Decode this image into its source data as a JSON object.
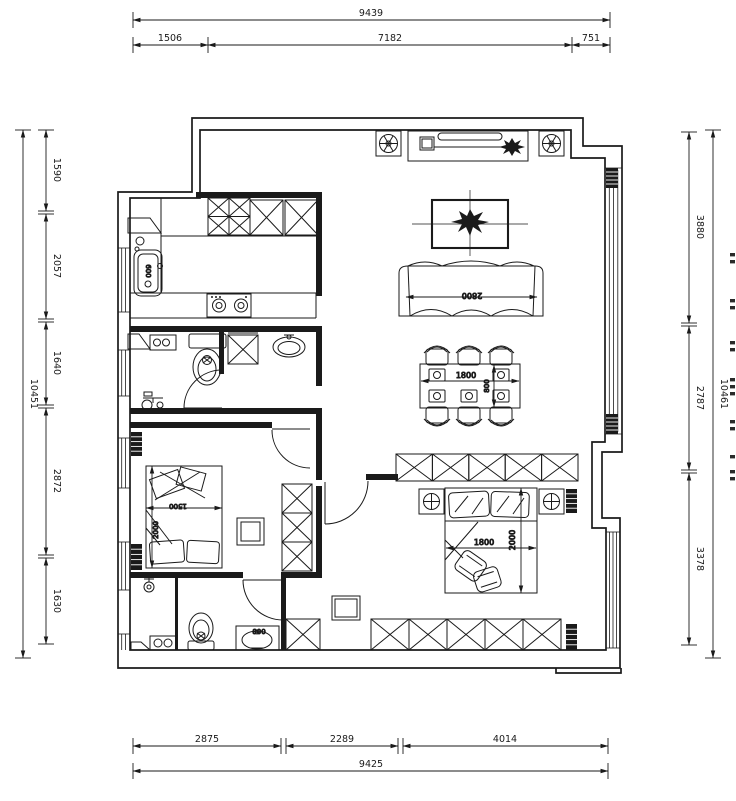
{
  "dimensions": {
    "top": {
      "overall": "9439",
      "segments": [
        "1506",
        "7182",
        "751"
      ]
    },
    "bottom": {
      "overall": "9425",
      "segments": [
        "2875",
        "2289",
        "4014"
      ]
    },
    "left": {
      "overall": "10451",
      "segments": [
        "1590",
        "2057",
        "1640",
        "2872",
        "1630"
      ]
    },
    "right": {
      "overall": "10461",
      "segments": [
        "3880",
        "2787",
        "3378"
      ]
    }
  },
  "labels": {
    "kitchen_sink": "600",
    "sofa_width": "2800",
    "dining_length": "1800",
    "dining_width": "800",
    "bed2_width": "1500",
    "bed2_length": "2000",
    "master_bed_width": "1800",
    "master_bed_length": "2000",
    "bath2_vanity": "800"
  }
}
